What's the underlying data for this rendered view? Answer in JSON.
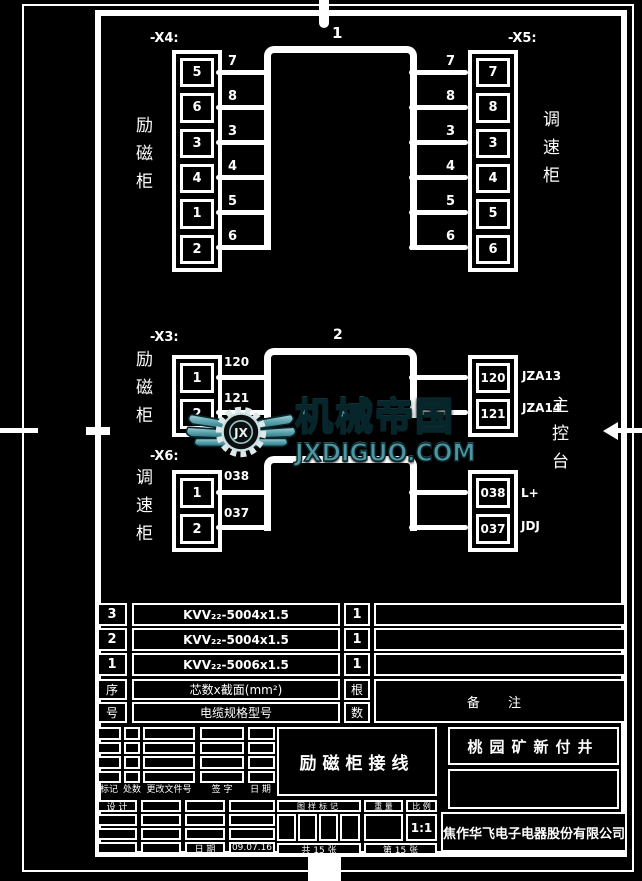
{
  "top": {
    "x4_label": "-X4:",
    "x5_label": "-X5:",
    "left_cabinet": "励磁柜",
    "right_cabinet": "调速柜",
    "cable_no": "1",
    "x4_cells": [
      "5",
      "6",
      "3",
      "4",
      "1",
      "2"
    ],
    "x5_cells": [
      "7",
      "8",
      "3",
      "4",
      "5",
      "6"
    ],
    "left_wires": [
      "7",
      "8",
      "3",
      "4",
      "5",
      "6"
    ],
    "right_wires": [
      "7",
      "8",
      "3",
      "4",
      "5",
      "6"
    ]
  },
  "mid": {
    "x3_label": "-X3:",
    "x3_cabinet": "励磁柜",
    "x3_cells": [
      "1",
      "2"
    ],
    "x3_wires": [
      "120",
      "121"
    ],
    "cable_no": "2",
    "right_top_cells": [
      "120",
      "121"
    ],
    "right_top_tags": [
      "JZA13",
      "JZA14"
    ],
    "console": "主控台",
    "x6_label": "-X6:",
    "x6_cabinet": "调速柜",
    "x6_cells": [
      "1",
      "2"
    ],
    "x6_wires": [
      "038",
      "037"
    ],
    "right_bot_cells": [
      "038",
      "037"
    ],
    "right_bot_tags": [
      "L+",
      "JDJ"
    ]
  },
  "watermark": {
    "brand": "机械帝国",
    "domain": "JXDIGUO.COM",
    "monogram": "JX",
    "teal": "#5ba2ad",
    "teal_light": "#a8d2d8",
    "teal_dark": "#2d6e79"
  },
  "cable_table": {
    "rows": [
      {
        "no": "3",
        "spec": "KVV₂₂-5004x1.5",
        "qty": "1",
        "remark": ""
      },
      {
        "no": "2",
        "spec": "KVV₂₂-5004x1.5",
        "qty": "1",
        "remark": ""
      },
      {
        "no": "1",
        "spec": "KVV₂₂-5006x1.5",
        "qty": "1",
        "remark": ""
      }
    ],
    "serial_top": "序",
    "serial_bottom": "号",
    "spec_header": "芯数x截面(mm²)",
    "model_header": "电缆规格型号",
    "qty_top": "根",
    "qty_bottom": "数",
    "remark_header": "备  注"
  },
  "title_block": {
    "revision_labels": [
      "标记",
      "处数",
      "更改文件号",
      "签 字",
      "日 期"
    ],
    "design_label": "设 计",
    "date_label": "日 期",
    "date_value": "09.07.16",
    "mark_header": "图样标记",
    "weight_header": "重 量",
    "scale_header": "比 例",
    "scale_value": "1:1",
    "sheets_total": "共 15 张",
    "sheet_no": "第 15 张",
    "drawing_title": "励磁柜接线",
    "project": "桃园矿新付井",
    "company": "焦作华飞电子电器股份有限公司"
  }
}
